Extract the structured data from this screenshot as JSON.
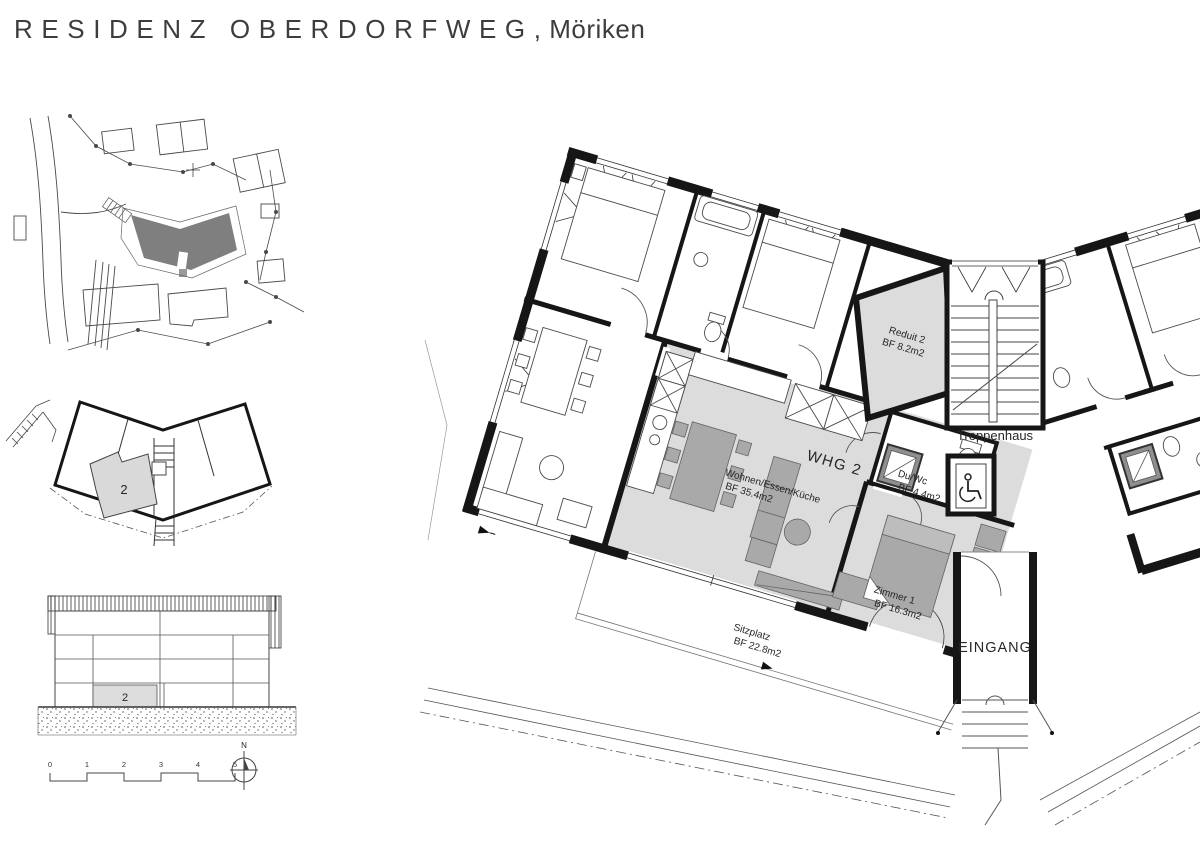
{
  "title": {
    "project": "RESIDENZ OBERDORFWEG",
    "location": ", Möriken"
  },
  "floor_plan": {
    "unit_label": "WHG 2",
    "rooms": {
      "wohnen": {
        "name": "Wohnen/Essen/Küche",
        "area": "BF 35.4m2"
      },
      "zimmer1": {
        "name": "Zimmer 1",
        "area": "BF 16.3m2"
      },
      "duwc": {
        "name": "Du/Wc",
        "area": "BF 4.4m2"
      },
      "reduit": {
        "name": "Reduit 2",
        "area": "BF 8.2m2"
      },
      "sitzplatz": {
        "name": "Sitzplatz",
        "area": "BF 22.8m2"
      }
    },
    "labels": {
      "stairs": "Treppenhaus",
      "entrance": "EINGANG",
      "washing_machine": "WM",
      "tumbler": "TU"
    }
  },
  "key_plan": {
    "unit_number": "2"
  },
  "elevation": {
    "unit_number": "2"
  },
  "scale_bar": {
    "ticks": [
      "0",
      "1",
      "2",
      "3",
      "4",
      "5"
    ]
  },
  "compass": {
    "north_label": "N"
  },
  "colors": {
    "wall": "#161616",
    "unit_highlight": "#dcdcdc",
    "furniture_gray": "#a9a9a9",
    "site_building": "#7f7f7f",
    "text": "#2a2a2a"
  }
}
